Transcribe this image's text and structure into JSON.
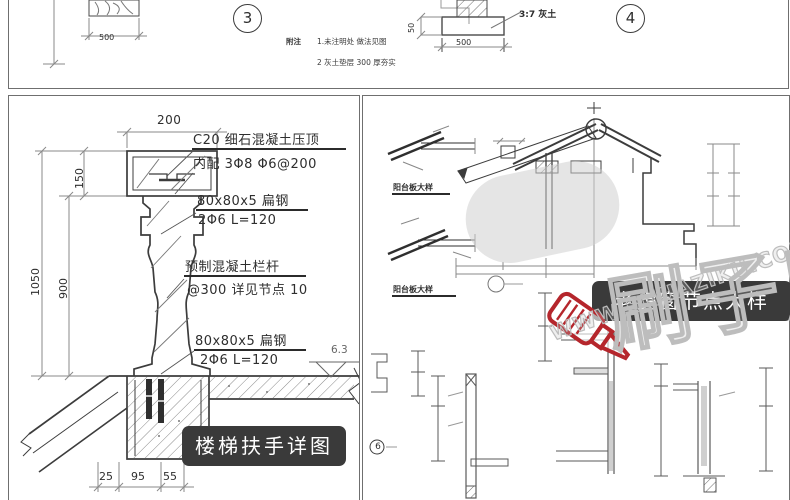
{
  "colors": {
    "badge_bg": "#3a3a3a",
    "badge_text": "#ffffff",
    "line": "#3c3c3c",
    "watermark_red": "#b5262c",
    "watermark_gray": "#bdbdbd"
  },
  "top_strip": {
    "left_detail_dim": "500",
    "bubble_3": "3",
    "bubble_4": "4",
    "notes_label": "附注",
    "note_line_1": "1.未注明处 做法见图",
    "note_line_2": "2  灰土垫层    300  厚夯实",
    "footing_label": "3:7 灰土",
    "footing_width_dim": "500",
    "footing_height_dim": "50"
  },
  "left_panel": {
    "badge_title": "楼梯扶手详图",
    "dim_top": "200",
    "dim_cap_height": "150",
    "dim_total_height": "1050",
    "dim_baluster_height": "900",
    "dim_bottom_1": "25",
    "dim_bottom_2": "95",
    "dim_bottom_3": "55",
    "elevation_mark": "6.3",
    "ann_cap_line1": "C20  细石混凝土压顶",
    "ann_cap_line2": "内配 3Φ8  Φ6@200",
    "ann_flat_steel_top_line1": "80x80x5   扁钢",
    "ann_flat_steel_top_line2": "2Φ6 L=120",
    "ann_baluster_line1": "预制混凝土栏杆",
    "ann_baluster_line2": "@300  详见节点  10",
    "ann_flat_steel_bottom_line1": "80x80x5   扁钢",
    "ann_flat_steel_bottom_line2": "2Φ6 L=120"
  },
  "right_panel": {
    "badge_title": "老虎窗节点大样",
    "sub_detail_title_1": "阳台板大样",
    "sub_detail_title_2": "阳台板大样",
    "bubble_6": "6"
  },
  "watermark": {
    "brand_cn": "刷子库",
    "brand_url": "WWW.SHUAZIKU.COM"
  }
}
